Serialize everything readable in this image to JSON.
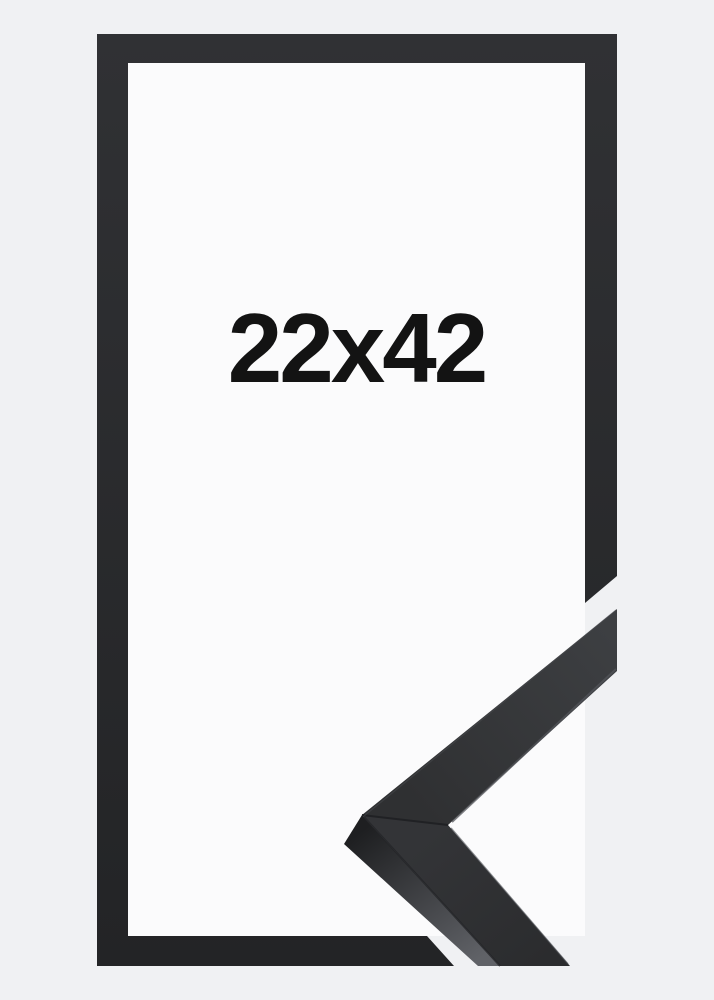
{
  "product": {
    "size_label": "22x42"
  },
  "colors": {
    "background": "#f0f1f3",
    "inner_area": "#fbfbfc",
    "frame_dark_top": "#303134",
    "frame_dark_bottom": "#232426",
    "arm_upper_face_light": "#3d3f42",
    "arm_upper_face_dark": "#2f3032",
    "arm_lower_face_light": "#333437",
    "arm_lower_face_dark": "#2b2c2e",
    "side_face_dark": "#1e1f21",
    "side_face_light": "#606267",
    "seam_line": "#202124",
    "edge_highlight": "#53555a",
    "label_text": "#131313"
  }
}
